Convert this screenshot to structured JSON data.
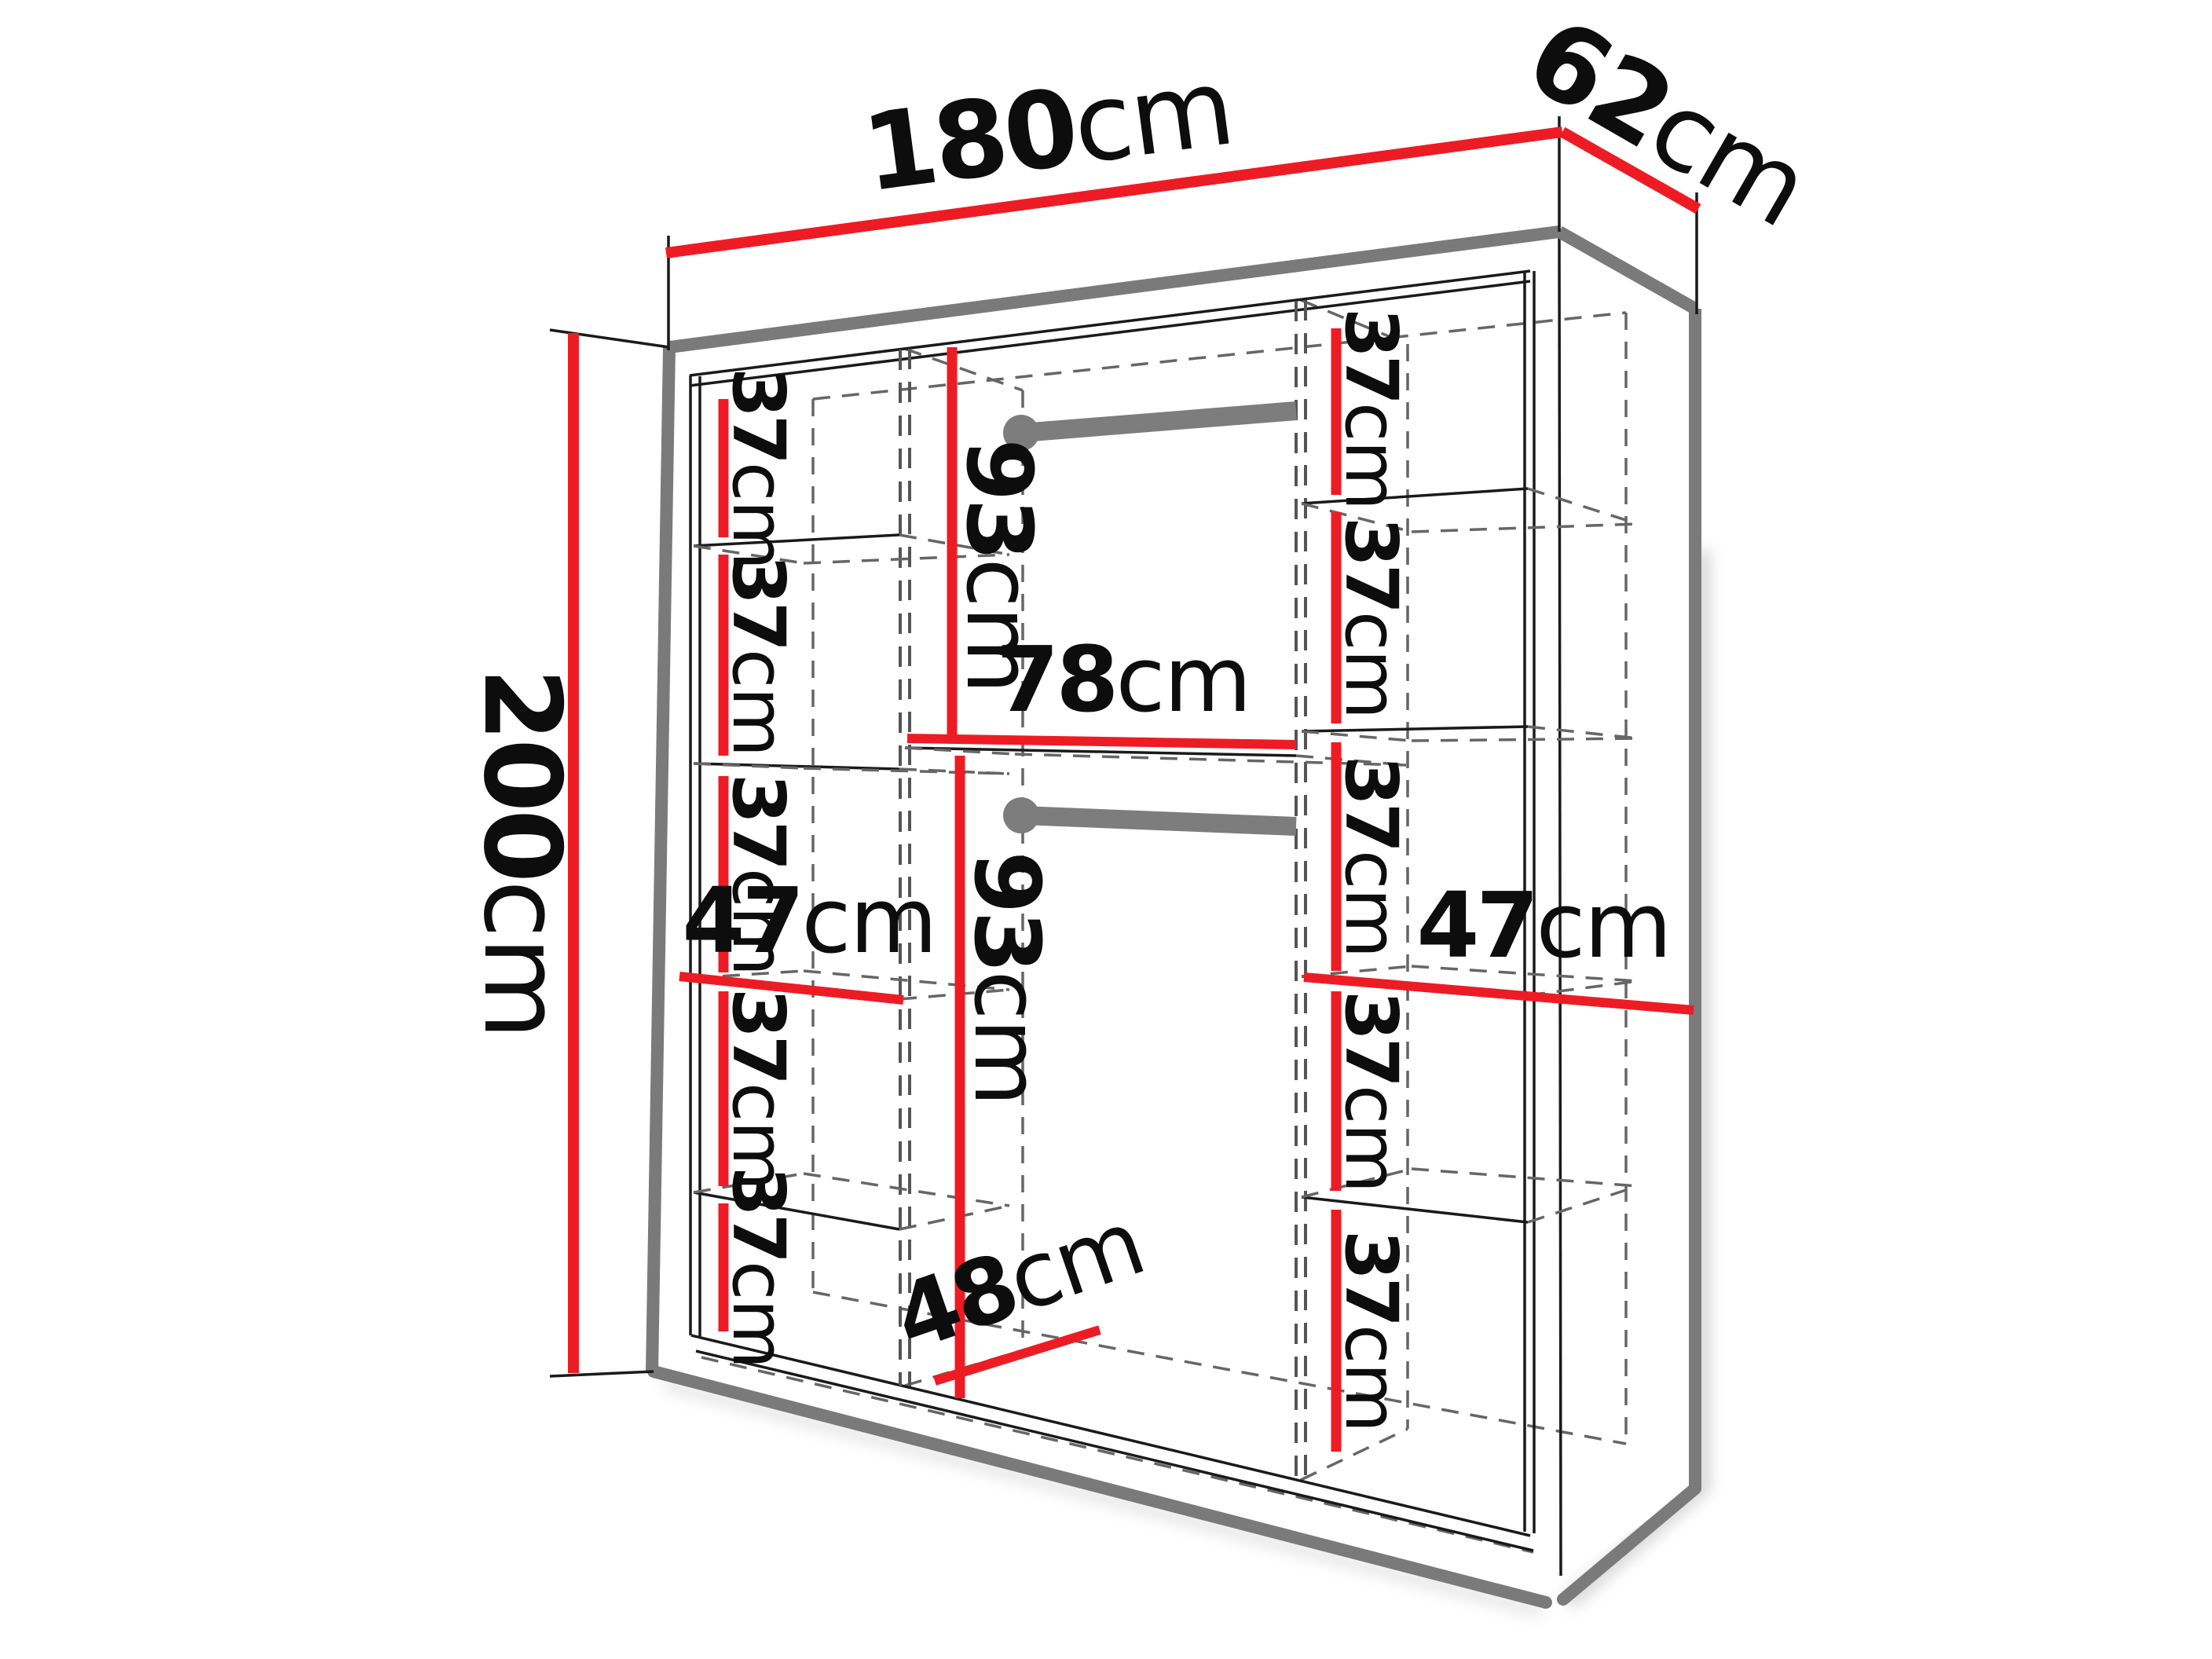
{
  "diagram_type": "wardrobe-dimension-drawing",
  "colors": {
    "dimension_red": "#ed1c24",
    "edge_gray": "#7a7a7a",
    "hidden_line_gray": "#666666",
    "rail_gray": "#7d7d7d",
    "text_black": "#0d0d0d",
    "background": "#ffffff"
  },
  "overall": {
    "width": {
      "v": "180",
      "u": "cm"
    },
    "depth": {
      "v": "62",
      "u": "cm"
    },
    "height": {
      "v": "200",
      "u": "cm"
    }
  },
  "left_column": {
    "gaps": [
      {
        "v": "37",
        "u": "cm"
      },
      {
        "v": "37",
        "u": "cm"
      },
      {
        "v": "37",
        "u": "cm"
      },
      {
        "v": "37",
        "u": "cm"
      },
      {
        "v": "37",
        "u": "cm"
      }
    ],
    "width": {
      "v": "47",
      "u": "cm"
    }
  },
  "middle_section": {
    "upper_height": {
      "v": "93",
      "u": "cm"
    },
    "width": {
      "v": "78",
      "u": "cm"
    },
    "lower_height": {
      "v": "93",
      "u": "cm"
    },
    "depth": {
      "v": "48",
      "u": "cm"
    }
  },
  "right_column": {
    "gaps": [
      {
        "v": "37",
        "u": "cm"
      },
      {
        "v": "37",
        "u": "cm"
      },
      {
        "v": "37",
        "u": "cm"
      },
      {
        "v": "37",
        "u": "cm"
      },
      {
        "v": "37",
        "u": "cm"
      }
    ],
    "width": {
      "v": "47",
      "u": "cm"
    }
  }
}
